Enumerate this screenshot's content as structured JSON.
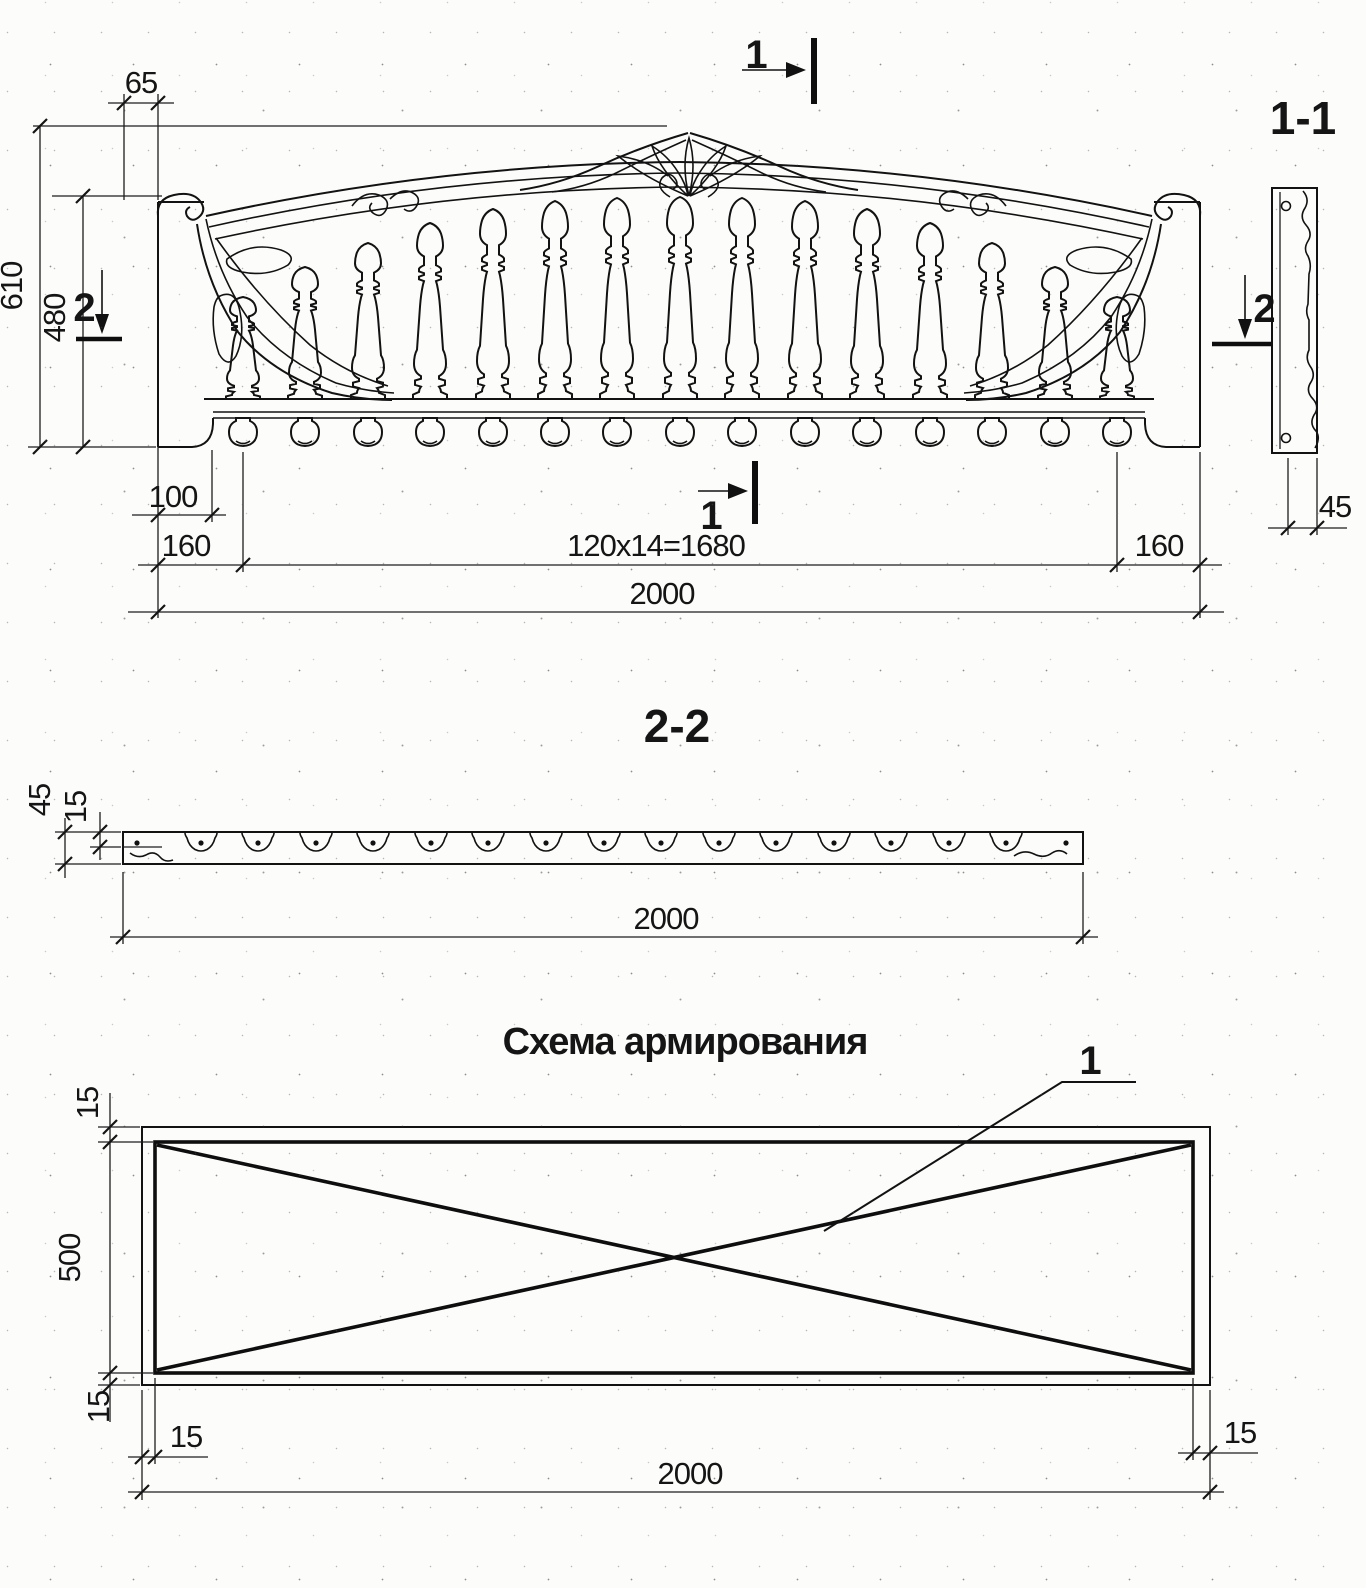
{
  "colors": {
    "ink": "#111111",
    "paper": "#fcfcfa"
  },
  "sheet": {
    "elevation": {
      "mark_top": "1",
      "mark_bottom": "1",
      "mark_left": "2",
      "mark_right": "2",
      "dim_65": "65",
      "dim_610": "610",
      "dim_480": "480",
      "dim_100": "100",
      "dim_160_left": "160",
      "dim_mid": "120x14=1680",
      "dim_160_right": "160",
      "dim_2000": "2000"
    },
    "section_1_1": {
      "label": "1-1",
      "dim_45": "45"
    },
    "section_2_2": {
      "label": "2-2",
      "dim_45": "45",
      "dim_15": "15",
      "dim_2000": "2000"
    },
    "reinforcement": {
      "title": "Схема армирования",
      "callout_1": "1",
      "dim_15_top": "15",
      "dim_500": "500",
      "dim_15_bottom": "15",
      "dim_15_bottom_left": "15",
      "dim_15_bottom_right": "15",
      "dim_2000": "2000"
    }
  }
}
